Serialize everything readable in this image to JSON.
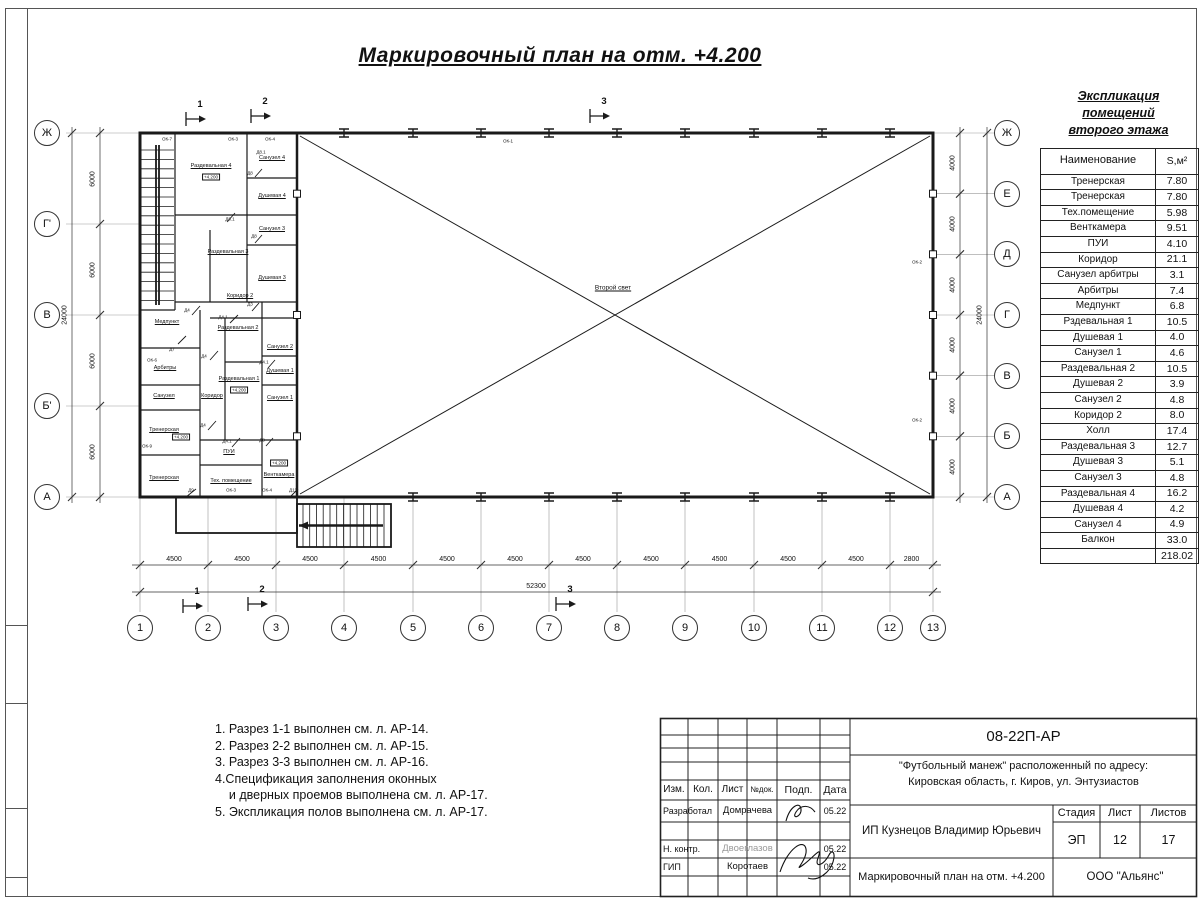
{
  "sheet": {
    "title": "Маркировочный план на отм. +4.200"
  },
  "plan": {
    "hall_label": "Второй свет",
    "elevation_mark": "+4.200",
    "rooms": [
      "Раздевальная 4",
      "Санузел 4",
      "Душевая 4",
      "Санузел 3",
      "Раздевальная 3",
      "Душевая 3",
      "Коридор 2",
      "Медпункт",
      "Арбитры",
      "Санузел",
      "Тренерская",
      "Тренерская",
      "Коридор",
      "Раздевальная 2",
      "Санузел 2",
      "Душевая 1",
      "Раздевальная 1",
      "Санузел 1",
      "ПУИ",
      "Тех. помещение",
      "Венткамера"
    ],
    "opening_tags": [
      "ОК-7",
      "ОК-3",
      "ОК-4",
      "ОК-1",
      "ОК-6",
      "ОК-9",
      "ОК-2",
      "ОК-2",
      "Д9",
      "ОК-3",
      "ОК-4",
      "Д11",
      "Д8",
      "Д8.1",
      "Д8",
      "Д8.1",
      "Д4",
      "Д4.1",
      "Д4",
      "Д4.1",
      "Д3",
      "Д7",
      "Д4",
      "Д4.1",
      "Д8"
    ],
    "grid": {
      "bottom": [
        "1",
        "2",
        "3",
        "4",
        "5",
        "6",
        "7",
        "8",
        "9",
        "10",
        "11",
        "12",
        "13"
      ],
      "left": [
        "Ж",
        "Г'",
        "В",
        "Б'",
        "А"
      ],
      "right": [
        "Ж",
        "Е",
        "Д",
        "Г",
        "В",
        "Б",
        "А"
      ]
    },
    "dims": {
      "bottom_spans": [
        "4500",
        "4500",
        "4500",
        "4500",
        "4500",
        "4500",
        "4500",
        "4500",
        "4500",
        "4500",
        "4500",
        "2800"
      ],
      "bottom_total": "52300",
      "left_spans": [
        "6000",
        "6000",
        "6000",
        "6000"
      ],
      "left_total": "24000",
      "right_spans": [
        "4000",
        "4000",
        "4000",
        "4000",
        "4000",
        "4000"
      ],
      "right_total": "24000"
    },
    "sections": [
      "1",
      "2",
      "3"
    ]
  },
  "explication": {
    "title_line1": "Экспликация помещений",
    "title_line2": "второго этажа",
    "col_name": "Наименование",
    "col_area": "S,м²",
    "rows": [
      [
        "Тренерская",
        "7.80"
      ],
      [
        "Тренерская",
        "7.80"
      ],
      [
        "Тех.помещение",
        "5.98"
      ],
      [
        "Венткамера",
        "9.51"
      ],
      [
        "ПУИ",
        "4.10"
      ],
      [
        "Коридор",
        "21.1"
      ],
      [
        "Санузел арбитры",
        "3.1"
      ],
      [
        "Арбитры",
        "7.4"
      ],
      [
        "Медпункт",
        "6.8"
      ],
      [
        "Рздевальная 1",
        "10.5"
      ],
      [
        "Душевая 1",
        "4.0"
      ],
      [
        "Санузел 1",
        "4.6"
      ],
      [
        "Раздевальная 2",
        "10.5"
      ],
      [
        "Душевая 2",
        "3.9"
      ],
      [
        "Санузел 2",
        "4.8"
      ],
      [
        "Коридор 2",
        "8.0"
      ],
      [
        "Холл",
        "17.4"
      ],
      [
        "Раздевальная 3",
        "12.7"
      ],
      [
        "Душевая 3",
        "5.1"
      ],
      [
        "Санузел 3",
        "4.8"
      ],
      [
        "Раздевальная 4",
        "16.2"
      ],
      [
        "Душевая 4",
        "4.2"
      ],
      [
        "Санузел 4",
        "4.9"
      ],
      [
        "Балкон",
        "33.0"
      ]
    ],
    "total": "218.02"
  },
  "notes": [
    "1. Разрез 1-1 выполнен см. л. АР-14.",
    "2. Разрез 2-2 выполнен см. л. АР-15.",
    "3. Разрез 3-3 выполнен см. л. АР-16.",
    "4.Спецификация заполнения оконных",
    "    и дверных проемов выполнена см. л. АР-17.",
    "5. Экспликация полов выполнена см. л. АР-17."
  ],
  "stamp": {
    "doc_number": "08-22П-АР",
    "project_line1": "\"Футбольный манеж\" расположенный по адресу:",
    "project_line2": "Кировская область, г. Киров, ул. Энтузиастов",
    "client": "ИП Кузнецов Владимир Юрьевич",
    "sheet_title": "Маркировочный план на отм. +4.200",
    "company": "ООО \"Альянс\"",
    "cols": {
      "izm": "Изм.",
      "kol": "Кол.",
      "list": "Лист",
      "ndok": "№док.",
      "podp": "Подп.",
      "data": "Дата"
    },
    "stage_label": "Стадия",
    "sheet_label": "Лист",
    "sheets_label": "Листов",
    "stage": "ЭП",
    "sheet_num": "12",
    "sheets_total": "17",
    "roles": [
      {
        "role": "Разработал",
        "name": "Домрачева",
        "date": "05.22"
      },
      {
        "role": "Н. контр.",
        "name": "Двоеглазов",
        "date": "05.22"
      },
      {
        "role": "ГИП",
        "name": "Коротаев",
        "date": "05.22"
      }
    ]
  }
}
